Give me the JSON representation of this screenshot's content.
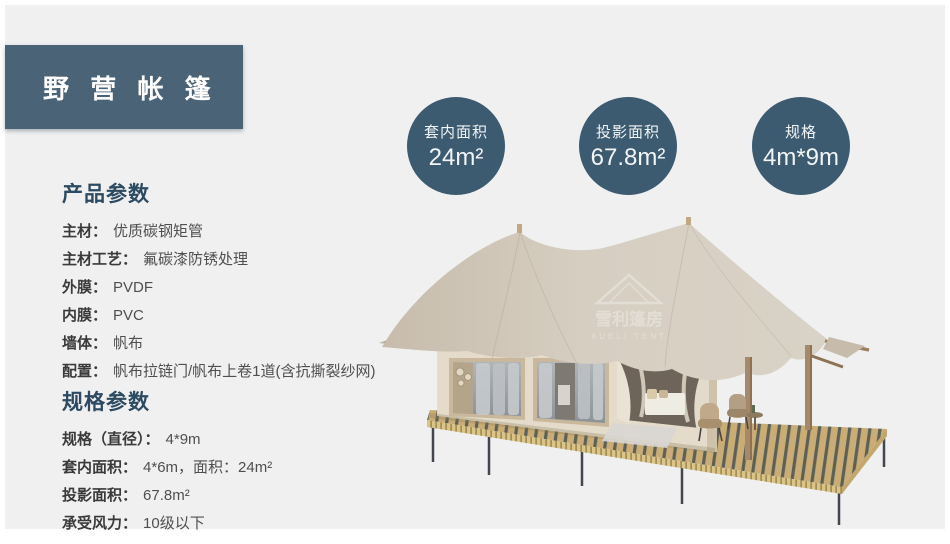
{
  "title": "野 营 帐 篷",
  "stats": [
    {
      "label": "套内面积",
      "value": "24m²"
    },
    {
      "label": "投影面积",
      "value": "67.8m²"
    },
    {
      "label": "规格",
      "value": "4m*9m"
    }
  ],
  "product_params": {
    "heading": "产品参数",
    "rows": [
      {
        "label": "主材：",
        "value": "优质碳钢矩管"
      },
      {
        "label": "主材工艺：",
        "value": "氟碳漆防锈处理"
      },
      {
        "label": "外膜：",
        "value": "PVDF"
      },
      {
        "label": "内膜：",
        "value": "PVC"
      },
      {
        "label": "墙体：",
        "value": "帆布"
      },
      {
        "label": "配置：",
        "value": "帆布拉链门/帆布上卷1道(含抗撕裂纱网)"
      }
    ]
  },
  "spec_params": {
    "heading": "规格参数",
    "rows": [
      {
        "label": "规格（直径）：",
        "value": "4*9m"
      },
      {
        "label": "套内面积：",
        "value": "4*6m，面积：24m²"
      },
      {
        "label": "投影面积：",
        "value": "67.8m²"
      },
      {
        "label": "承受风力：",
        "value": "10级以下"
      }
    ]
  },
  "watermark": {
    "cn": "雪利篷房",
    "en": "XUELI TENT"
  },
  "colors": {
    "accent": "#4b6377",
    "circle": "#3c5a70",
    "heading": "#2c4a61",
    "background": "#f0f0f1",
    "canopy": "#d3cabd",
    "deck": "#c9ad74"
  }
}
